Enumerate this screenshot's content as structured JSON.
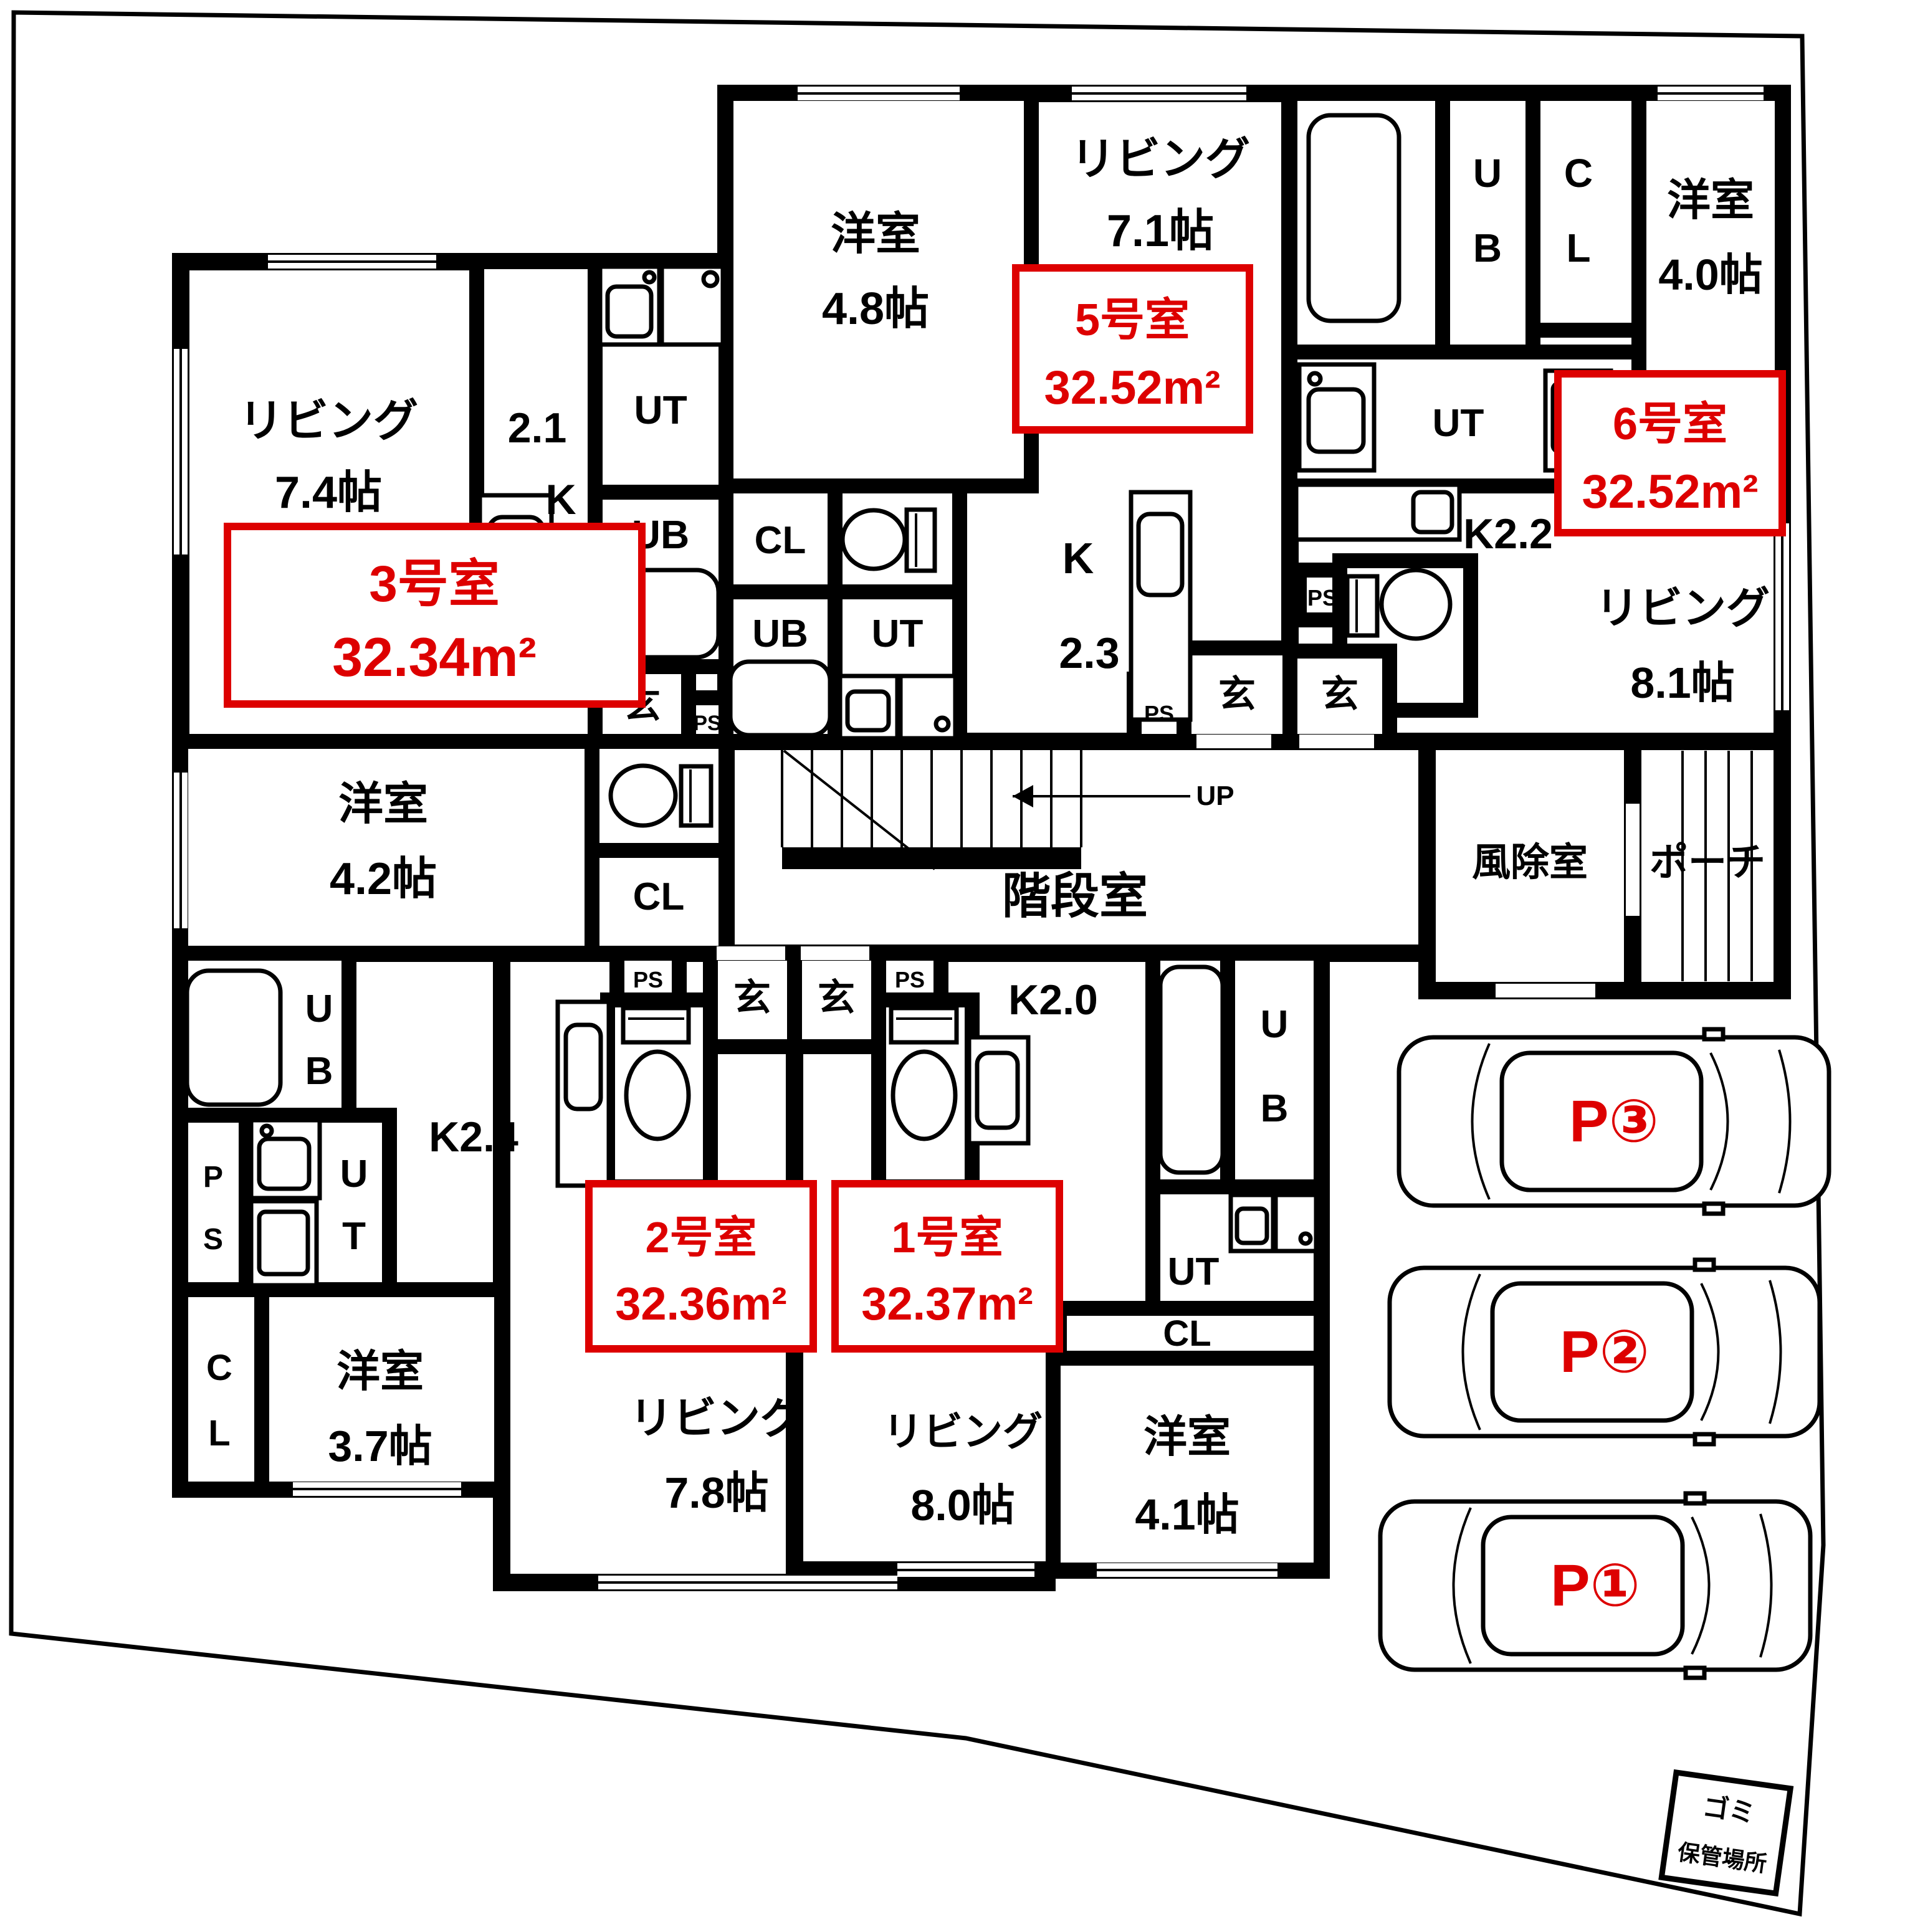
{
  "colors": {
    "red": "#dd0000",
    "wall": "#000000"
  },
  "abbr": {
    "ub": "UB",
    "ut": "UT",
    "cl": "CL",
    "ps": "PS",
    "genkan": "玄"
  },
  "letters": {
    "u": "U",
    "b": "B",
    "c": "C",
    "l": "L",
    "t": "T",
    "p": "P",
    "s": "S"
  },
  "units": {
    "u3": {
      "name": "3号室",
      "area": "32.34m²",
      "living1": "リビング",
      "living2": "7.4帖",
      "kitchen1": "2.1",
      "kitchen2": "K",
      "bed1": "洋室",
      "bed2": "4.2帖"
    },
    "u5": {
      "name": "5号室",
      "area": "32.52m²",
      "living1": "リビング",
      "living2": "7.1帖",
      "kitchen1": "K",
      "kitchen2": "2.3",
      "bed1": "洋室",
      "bed2": "4.8帖"
    },
    "u6": {
      "name": "6号室",
      "area": "32.52m²",
      "living1": "リビング",
      "living2": "8.1帖",
      "kitchen": "K2.2",
      "bed1": "洋室",
      "bed2": "4.0帖"
    },
    "u2": {
      "name": "2号室",
      "area": "32.36m²",
      "living1": "リビング",
      "living2": "7.8帖",
      "kitchen": "K2.4",
      "bed1": "洋室",
      "bed2": "3.7帖"
    },
    "u1": {
      "name": "1号室",
      "area": "32.37m²",
      "living1": "リビング",
      "living2": "8.0帖",
      "kitchen": "K2.0",
      "bed1": "洋室",
      "bed2": "4.1帖"
    }
  },
  "common": {
    "stairwell": "階段室",
    "up": "UP",
    "windbreak": "風除室",
    "porch": "ポーチ"
  },
  "parking": {
    "p3": "P③",
    "p2": "P②",
    "p1": "P①"
  },
  "garbage": {
    "line1": "ゴミ",
    "line2": "保管場所"
  }
}
